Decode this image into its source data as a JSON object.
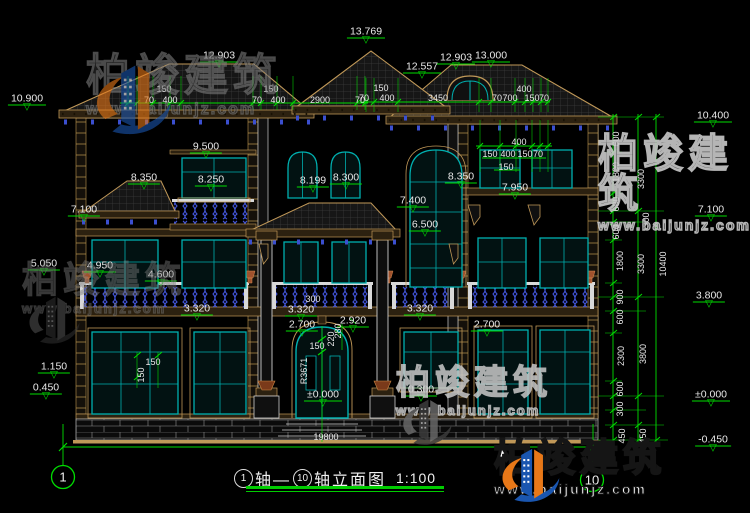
{
  "figure": {
    "axis_start": "1",
    "axis_mid_text": "轴—",
    "axis_end": "10",
    "axis_suffix_text": "轴立面图",
    "scale": "1:100"
  },
  "brand": {
    "name": "柏竣建筑",
    "url": "www.baijunjz.com"
  },
  "colors": {
    "dimension_green": "#00dd00",
    "window_teal": "#00b0b0",
    "baluster_blue": "#4254d8",
    "trim_tan": "#c09858",
    "text_white": "#e8e8e8",
    "background": "#000000"
  },
  "annotations": {
    "levels": [
      {
        "text": "10.900",
        "x": 27,
        "y": 99
      },
      {
        "text": "12.903",
        "x": 219,
        "y": 56
      },
      {
        "text": "13.769",
        "x": 366,
        "y": 32
      },
      {
        "text": "12.557",
        "x": 422,
        "y": 67
      },
      {
        "text": "12.903",
        "x": 456,
        "y": 58
      },
      {
        "text": "13.000",
        "x": 491,
        "y": 56
      },
      {
        "text": "10.400",
        "x": 713,
        "y": 116
      },
      {
        "text": "9.500",
        "x": 206,
        "y": 147
      },
      {
        "text": "8.350",
        "x": 144,
        "y": 178
      },
      {
        "text": "8.250",
        "x": 211,
        "y": 180
      },
      {
        "text": "8.199",
        "x": 313,
        "y": 181
      },
      {
        "text": "8.300",
        "x": 346,
        "y": 178
      },
      {
        "text": "8.350",
        "x": 461,
        "y": 177
      },
      {
        "text": "7.950",
        "x": 515,
        "y": 188
      },
      {
        "text": "7.400",
        "x": 413,
        "y": 201
      },
      {
        "text": "6.500",
        "x": 425,
        "y": 225
      },
      {
        "text": "7.100",
        "x": 84,
        "y": 210
      },
      {
        "text": "7.100",
        "x": 711,
        "y": 210
      },
      {
        "text": "5.050",
        "x": 44,
        "y": 264
      },
      {
        "text": "4.950",
        "x": 100,
        "y": 266
      },
      {
        "text": "4.600",
        "x": 161,
        "y": 275
      },
      {
        "text": "3.320",
        "x": 197,
        "y": 309
      },
      {
        "text": "3.320",
        "x": 301,
        "y": 310
      },
      {
        "text": "3.320",
        "x": 420,
        "y": 309
      },
      {
        "text": "3.800",
        "x": 709,
        "y": 296
      },
      {
        "text": "2.700",
        "x": 302,
        "y": 325
      },
      {
        "text": "2.920",
        "x": 353,
        "y": 321
      },
      {
        "text": "2.700",
        "x": 487,
        "y": 325
      },
      {
        "text": "1.150",
        "x": 54,
        "y": 367
      },
      {
        "text": "0.450",
        "x": 46,
        "y": 388
      },
      {
        "text": "±0.000",
        "x": 323,
        "y": 395
      },
      {
        "text": "0.300",
        "x": 421,
        "y": 390
      },
      {
        "text": "±0.000",
        "x": 711,
        "y": 395
      },
      {
        "text": "-0.450",
        "x": 713,
        "y": 440
      }
    ],
    "dims_h": [
      {
        "text": "150",
        "x": 164,
        "y": 89
      },
      {
        "text": "70",
        "x": 149,
        "y": 100
      },
      {
        "text": "400",
        "x": 170,
        "y": 100
      },
      {
        "text": "150",
        "x": 271,
        "y": 89
      },
      {
        "text": "70",
        "x": 257,
        "y": 100
      },
      {
        "text": "400",
        "x": 278,
        "y": 100
      },
      {
        "text": "2900",
        "x": 320,
        "y": 100
      },
      {
        "text": "70",
        "x": 360,
        "y": 100
      },
      {
        "text": "150",
        "x": 381,
        "y": 88
      },
      {
        "text": "70",
        "x": 364,
        "y": 98
      },
      {
        "text": "400",
        "x": 387,
        "y": 98
      },
      {
        "text": "3450",
        "x": 438,
        "y": 98
      },
      {
        "text": "400",
        "x": 524,
        "y": 89
      },
      {
        "text": "70",
        "x": 497,
        "y": 98
      },
      {
        "text": "700",
        "x": 510,
        "y": 98
      },
      {
        "text": "150",
        "x": 532,
        "y": 98
      },
      {
        "text": "70",
        "x": 544,
        "y": 98
      },
      {
        "text": "400",
        "x": 519,
        "y": 142
      },
      {
        "text": "150",
        "x": 490,
        "y": 154
      },
      {
        "text": "400",
        "x": 508,
        "y": 154
      },
      {
        "text": "150",
        "x": 525,
        "y": 154
      },
      {
        "text": "70",
        "x": 538,
        "y": 154
      },
      {
        "text": "150",
        "x": 506,
        "y": 167
      },
      {
        "text": "150",
        "x": 153,
        "y": 362
      },
      {
        "text": "150",
        "x": 317,
        "y": 346
      },
      {
        "text": "300",
        "x": 313,
        "y": 299
      },
      {
        "text": "19800",
        "x": 326,
        "y": 437
      }
    ],
    "dims_v": [
      {
        "text": "150",
        "x": 141,
        "y": 375
      },
      {
        "text": "280",
        "x": 338,
        "y": 331
      },
      {
        "text": "220",
        "x": 331,
        "y": 339
      },
      {
        "text": "R3671",
        "x": 304,
        "y": 371
      },
      {
        "text": "600",
        "x": 616,
        "y": 139
      },
      {
        "text": "1800",
        "x": 616,
        "y": 172
      },
      {
        "text": "600",
        "x": 616,
        "y": 204
      },
      {
        "text": "600",
        "x": 616,
        "y": 232
      },
      {
        "text": "1800",
        "x": 620,
        "y": 261
      },
      {
        "text": "900",
        "x": 620,
        "y": 297
      },
      {
        "text": "600",
        "x": 620,
        "y": 317
      },
      {
        "text": "2300",
        "x": 621,
        "y": 356
      },
      {
        "text": "600",
        "x": 620,
        "y": 389
      },
      {
        "text": "300",
        "x": 620,
        "y": 409
      },
      {
        "text": "450",
        "x": 622,
        "y": 436
      },
      {
        "text": "450",
        "x": 643,
        "y": 436
      },
      {
        "text": "3300",
        "x": 641,
        "y": 179
      },
      {
        "text": "300",
        "x": 646,
        "y": 220
      },
      {
        "text": "3300",
        "x": 641,
        "y": 264
      },
      {
        "text": "3800",
        "x": 643,
        "y": 354
      },
      {
        "text": "10400",
        "x": 663,
        "y": 264
      }
    ]
  }
}
